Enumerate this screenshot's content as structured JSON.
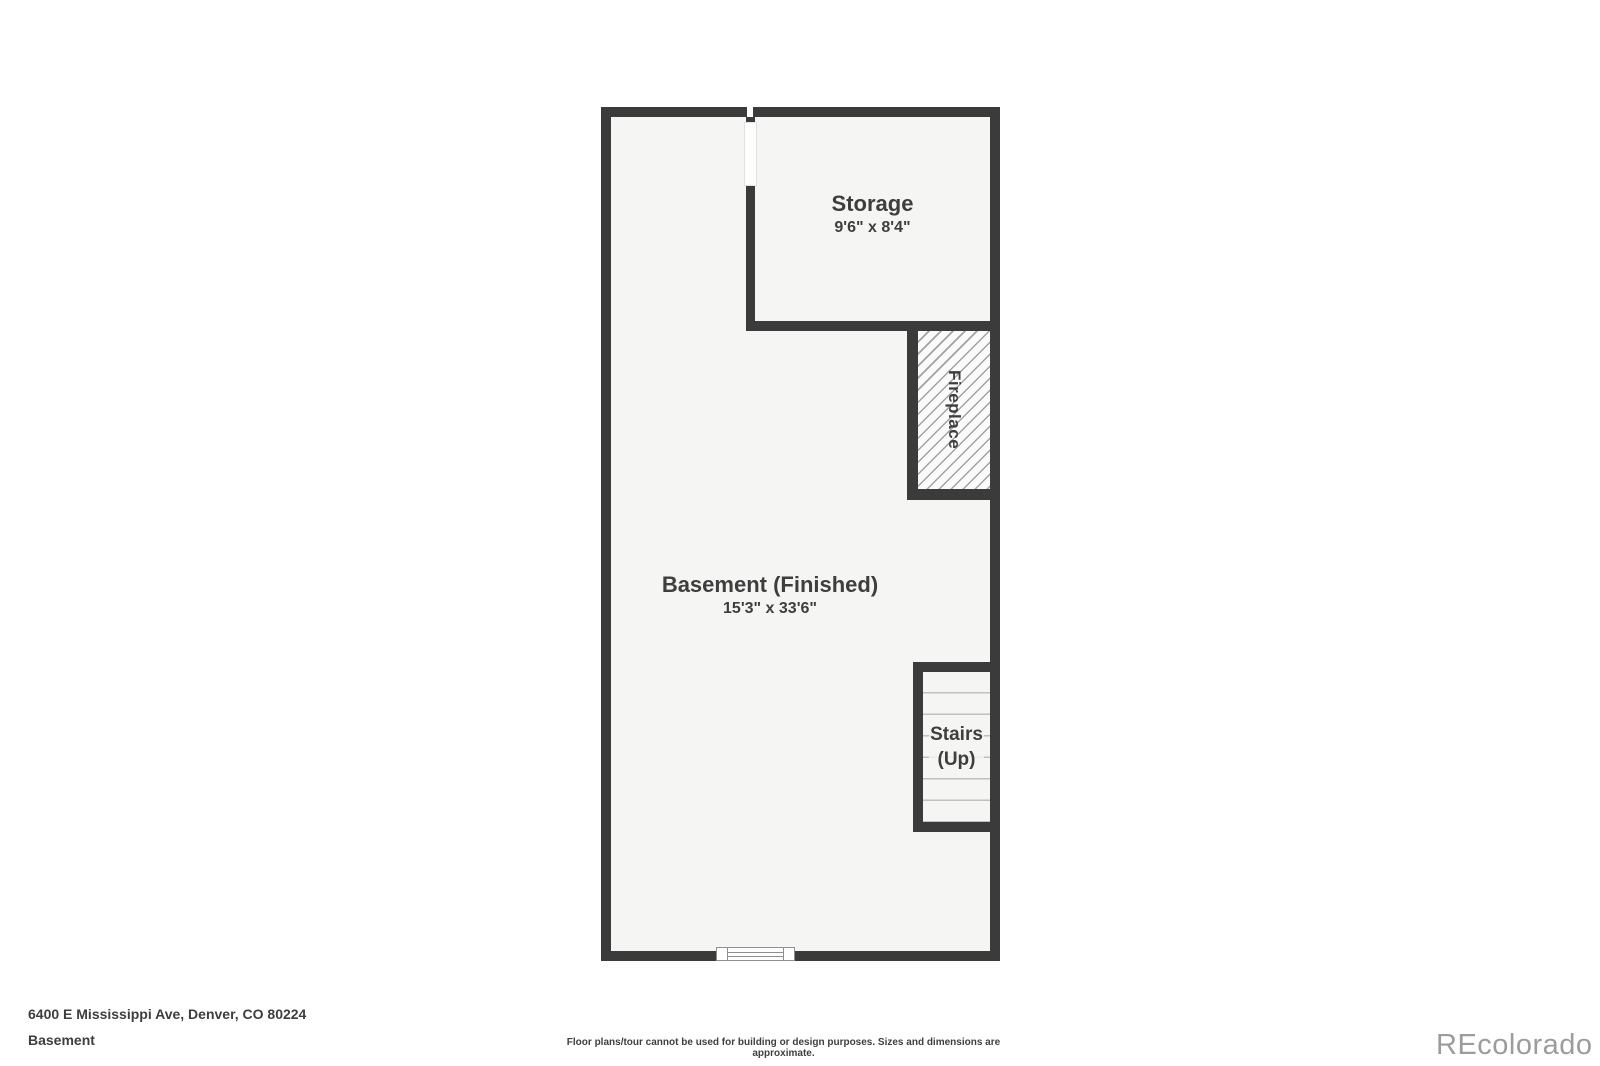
{
  "plan": {
    "rooms": {
      "storage": {
        "label": "Storage",
        "dims": "9'6\" x 8'4\""
      },
      "basement": {
        "label": "Basement (Finished)",
        "dims": "15'3\" x 33'6\""
      },
      "stairs": {
        "label_line1": "Stairs",
        "label_line2": "(Up)"
      },
      "fireplace": {
        "label": "Fireplace"
      }
    },
    "colors": {
      "wall": "#3b3b3b",
      "floor": "#f5f5f4",
      "hatch_line": "#a2a2a2",
      "tread_line": "#c0c0c0",
      "label_text": "#3e3e3e"
    }
  },
  "footer": {
    "address": "6400 E Mississippi Ave, Denver, CO 80224",
    "floor_name": "Basement",
    "disclaimer": "Floor plans/tour cannot be used for building or design purposes. Sizes and dimensions are approximate.",
    "watermark": "REcolorado",
    "watermark_color": "#9c9c9c"
  }
}
